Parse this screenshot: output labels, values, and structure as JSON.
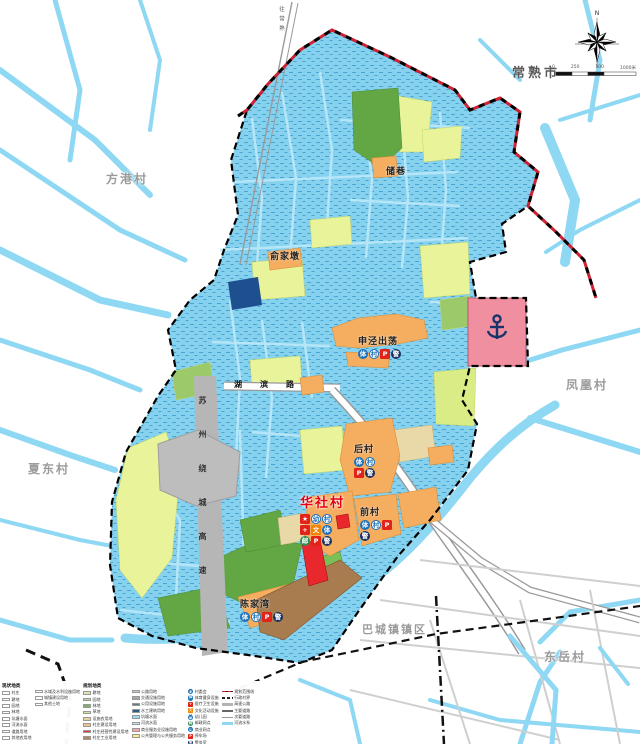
{
  "map": {
    "city_label": "常熟市",
    "compass_n": "N",
    "scale_ticks": [
      "0",
      "250",
      "500",
      "1000米"
    ],
    "neighbors": [
      {
        "name": "方港村"
      },
      {
        "name": "夏东村"
      },
      {
        "name": "凤凰村"
      },
      {
        "name": "东岳村"
      }
    ],
    "town_label": "巴城镇镇区",
    "main_village": {
      "name": "华社村"
    },
    "hamlets": [
      {
        "name": "储巷"
      },
      {
        "name": "俞家墩"
      },
      {
        "name": "申泾出荡"
      },
      {
        "name": "后村"
      },
      {
        "name": "前村"
      },
      {
        "name": "陈家湾"
      }
    ],
    "roads": {
      "expressway": "苏州绕城高速",
      "local_road": "湖滨路",
      "to_city": "往常熟"
    },
    "badge_set": [
      {
        "ch": "体",
        "cls": "b-blue"
      },
      {
        "ch": "村",
        "cls": "b-white"
      },
      {
        "ch": "P",
        "cls": "b-red"
      },
      {
        "ch": "警",
        "cls": "b-navy"
      }
    ],
    "main_badges": [
      {
        "ch": "★",
        "cls": "b-red"
      },
      {
        "ch": "幼",
        "cls": "b-white"
      },
      {
        "ch": "村",
        "cls": "b-white"
      },
      {
        "ch": "+",
        "cls": "b-red"
      },
      {
        "ch": "文",
        "cls": "b-orange"
      },
      {
        "ch": "体",
        "cls": "b-blue"
      },
      {
        "ch": "邮",
        "cls": "b-green"
      },
      {
        "ch": "P",
        "cls": "b-red"
      },
      {
        "ch": "警",
        "cls": "b-navy"
      }
    ]
  },
  "legend": {
    "current_title": "现状地类",
    "planned_title": "规划地类",
    "col1": {
      "items": [
        {
          "label": "村庄"
        },
        {
          "label": "耕地"
        },
        {
          "label": "园地"
        },
        {
          "label": "林地"
        },
        {
          "label": "坑塘水面"
        },
        {
          "label": "河流水面"
        },
        {
          "label": "道路用地"
        },
        {
          "label": "其他农用地"
        }
      ]
    },
    "col2": {
      "items": [
        {
          "label": "水域及水利设施用地"
        },
        {
          "label": "城镇建设用地"
        },
        {
          "label": "其他土地"
        }
      ]
    },
    "col3": {
      "items": [
        {
          "label": "耕地",
          "color": "#d9e8b4"
        },
        {
          "label": "园地",
          "color": "#b5d69a"
        },
        {
          "label": "林地",
          "color": "#7fb069"
        },
        {
          "label": "草地",
          "color": "#cfe3a0"
        },
        {
          "label": "设施农用地",
          "color": "#e3d3a3"
        },
        {
          "label": "村庄建设用地",
          "color": "#f2bf8e"
        },
        {
          "label": "村庄经营性建设用地",
          "color": "#e33b30"
        },
        {
          "label": "村庄工业用地",
          "color": "#b58a63"
        }
      ]
    },
    "col4": {
      "items": [
        {
          "label": "公路用地",
          "color": "#c9c9c9"
        },
        {
          "label": "交通设施用地",
          "color": "#a6a6a6"
        },
        {
          "label": "公用设施用地",
          "color": "#5c7f71"
        },
        {
          "label": "水工建筑用地",
          "color": "#2e5f8a"
        },
        {
          "label": "坑塘水面",
          "color": "#9fd9ef"
        },
        {
          "label": "河流水面",
          "color": "#bfe9f7"
        },
        {
          "label": "商业服务业设施用地",
          "color": "#f2a7b3"
        },
        {
          "label": "公共管理与公共服务用地",
          "color": "#f7ef8e"
        }
      ]
    },
    "col5": {
      "items": [
        {
          "symbol": "村",
          "cls": "b-white",
          "label": "村委会"
        },
        {
          "symbol": "体",
          "cls": "b-blue",
          "label": "体育健身设施"
        },
        {
          "symbol": "+",
          "cls": "b-red",
          "label": "医疗卫生设施"
        },
        {
          "symbol": "文",
          "cls": "b-orange",
          "label": "文化活动设施"
        },
        {
          "symbol": "幼",
          "cls": "b-white",
          "label": "幼儿园"
        },
        {
          "symbol": "邮",
          "cls": "b-green",
          "label": "邮政网点"
        },
        {
          "symbol": "商",
          "cls": "b-white",
          "label": "商业网点"
        },
        {
          "symbol": "P",
          "cls": "b-red",
          "label": "停车场"
        },
        {
          "symbol": "警",
          "cls": "b-navy",
          "label": "警务室"
        }
      ]
    },
    "col6": {
      "items": [
        {
          "label": "规划范围线",
          "cls": "ls-redblack"
        },
        {
          "label": "行政村界",
          "cls": "ls-blackdash"
        },
        {
          "label": "高速公路",
          "cls": "ls-gray"
        },
        {
          "label": "主要道路",
          "cls": "ls-double"
        },
        {
          "label": "次要道路",
          "cls": "ls-thin"
        },
        {
          "label": "河流水系",
          "cls": "ls-blue"
        }
      ]
    }
  },
  "palette": {
    "water": "#8ed8f3",
    "paddy": "#85d1ee",
    "orchard": "#e9f399",
    "forest": "#62a744",
    "village_built": "#f5ad5f",
    "industry_brown": "#a97c50",
    "planned_red": "#e8282d",
    "port_pink": "#f08f9f",
    "expressway_gray": "#b6b6b6",
    "city_boundary_red": "#cc2233"
  }
}
